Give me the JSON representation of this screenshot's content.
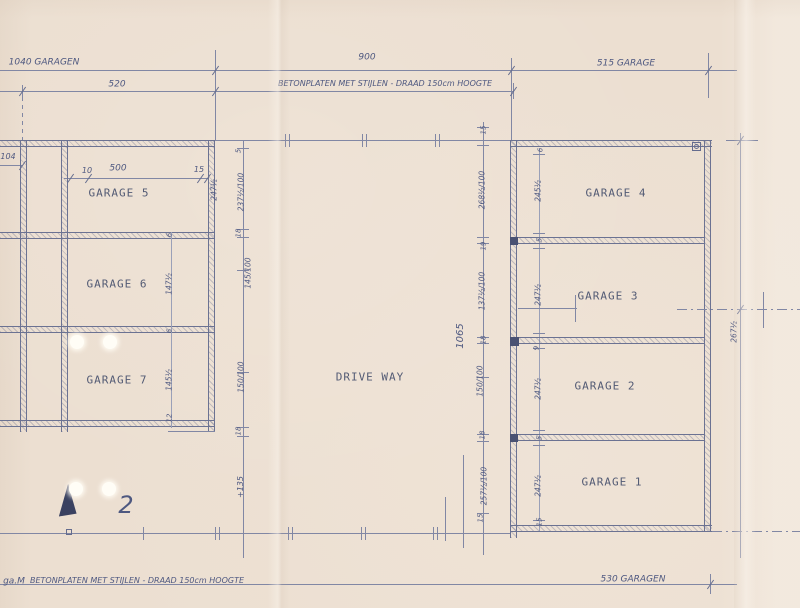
{
  "summary": {
    "sheet_kind": "garage site plan (scanned pencil drawing)",
    "sheet_number": "2",
    "rooms": [
      "GARAGE 1",
      "GARAGE 2",
      "GARAGE 3",
      "GARAGE 4",
      "GARAGE 5",
      "GARAGE 6",
      "GARAGE 7",
      "DRIVE WAY"
    ],
    "top_annotations": [
      "1040 GARAGEN",
      "520",
      "900",
      "BETONPLATEN MET STIJLEN - DRAAD 150cm HOOGTE",
      "515 GARAGE"
    ],
    "bottom_annotations": [
      "ga.M",
      "BETONPLATEN MET STIJLEN - DRAAD 150cm HOOGTE",
      "530 GARAGEN"
    ],
    "driveway_length_dim": "1065"
  },
  "paper": {
    "bg": "#ecdfd1",
    "ink": "#8187a4",
    "wall_ink": "#6b7292",
    "print_ink": "#525a74",
    "hand_ink": "#4e5880"
  },
  "drawing": {
    "north_arrow": {
      "x": 58,
      "y": 484,
      "w": 21,
      "h": 32,
      "color": "#3a4160",
      "tilt": -3
    },
    "lines": [
      {
        "t": "h",
        "x": 0,
        "y": 70,
        "l": 737
      },
      {
        "t": "v",
        "x": 215,
        "y": 50,
        "l": 90
      },
      {
        "t": "v",
        "x": 511,
        "y": 58,
        "l": 82
      },
      {
        "t": "v",
        "x": 708,
        "y": 53,
        "l": 45
      },
      {
        "t": "h",
        "x": 0,
        "y": 91,
        "l": 513
      },
      {
        "t": "v",
        "x": 22,
        "y": 85,
        "l": 12
      },
      {
        "t": "dashv",
        "x": 22,
        "y": 97,
        "l": 43
      },
      {
        "t": "v",
        "x": 513,
        "y": 83,
        "l": 16
      },
      {
        "t": "h",
        "x": 0,
        "y": 165,
        "l": 22
      },
      {
        "t": "h",
        "x": 64,
        "y": 178,
        "l": 144
      },
      {
        "t": "wallh",
        "x": 0,
        "y": 140,
        "l": 215
      },
      {
        "t": "wallv",
        "x": 20,
        "y": 140,
        "l": 292
      },
      {
        "t": "wallv",
        "x": 61,
        "y": 140,
        "l": 292
      },
      {
        "t": "wallv",
        "x": 208,
        "y": 140,
        "l": 292
      },
      {
        "t": "wallh",
        "x": 0,
        "y": 232,
        "l": 215
      },
      {
        "t": "wallh",
        "x": 0,
        "y": 326,
        "l": 215
      },
      {
        "t": "wallh",
        "x": 0,
        "y": 420,
        "l": 215
      },
      {
        "t": "h",
        "x": 168,
        "y": 431,
        "l": 47
      },
      {
        "t": "v",
        "x": 171,
        "y": 232,
        "l": 196,
        "c": "#9aa0b8"
      },
      {
        "t": "v",
        "x": 243,
        "y": 140,
        "l": 418
      },
      {
        "t": "v",
        "x": 483,
        "y": 122,
        "l": 433
      },
      {
        "t": "v",
        "x": 463,
        "y": 455,
        "l": 93
      },
      {
        "t": "v",
        "x": 445,
        "y": 497,
        "l": 44
      },
      {
        "t": "h",
        "x": 237,
        "y": 148,
        "l": 12
      },
      {
        "t": "h",
        "x": 237,
        "y": 229,
        "l": 12
      },
      {
        "t": "h",
        "x": 237,
        "y": 237,
        "l": 12
      },
      {
        "t": "h",
        "x": 237,
        "y": 270,
        "l": 12
      },
      {
        "t": "h",
        "x": 237,
        "y": 372,
        "l": 12
      },
      {
        "t": "h",
        "x": 237,
        "y": 427,
        "l": 12
      },
      {
        "t": "h",
        "x": 237,
        "y": 436,
        "l": 12
      },
      {
        "t": "h",
        "x": 477,
        "y": 127,
        "l": 12
      },
      {
        "t": "h",
        "x": 477,
        "y": 145,
        "l": 12
      },
      {
        "t": "h",
        "x": 477,
        "y": 237,
        "l": 12
      },
      {
        "t": "h",
        "x": 477,
        "y": 243,
        "l": 12
      },
      {
        "t": "h",
        "x": 477,
        "y": 337,
        "l": 12
      },
      {
        "t": "h",
        "x": 477,
        "y": 343,
        "l": 12
      },
      {
        "t": "h",
        "x": 477,
        "y": 377,
        "l": 12
      },
      {
        "t": "h",
        "x": 477,
        "y": 434,
        "l": 12
      },
      {
        "t": "h",
        "x": 477,
        "y": 441,
        "l": 12
      },
      {
        "t": "h",
        "x": 477,
        "y": 513,
        "l": 12
      },
      {
        "t": "v",
        "x": 539,
        "y": 148,
        "l": 384,
        "c": "#9aa0b8"
      },
      {
        "t": "h",
        "x": 533,
        "y": 154,
        "l": 12
      },
      {
        "t": "h",
        "x": 533,
        "y": 233,
        "l": 12
      },
      {
        "t": "h",
        "x": 533,
        "y": 248,
        "l": 12
      },
      {
        "t": "h",
        "x": 533,
        "y": 333,
        "l": 12
      },
      {
        "t": "h",
        "x": 533,
        "y": 348,
        "l": 12
      },
      {
        "t": "h",
        "x": 533,
        "y": 430,
        "l": 12
      },
      {
        "t": "h",
        "x": 533,
        "y": 445,
        "l": 12
      },
      {
        "t": "h",
        "x": 533,
        "y": 520,
        "l": 12
      },
      {
        "t": "h",
        "x": 215,
        "y": 140,
        "l": 295
      },
      {
        "t": "v",
        "x": 285,
        "y": 134,
        "l": 13
      },
      {
        "t": "v",
        "x": 289,
        "y": 134,
        "l": 13
      },
      {
        "t": "v",
        "x": 362,
        "y": 134,
        "l": 13
      },
      {
        "t": "v",
        "x": 366,
        "y": 134,
        "l": 13
      },
      {
        "t": "v",
        "x": 435,
        "y": 134,
        "l": 13
      },
      {
        "t": "v",
        "x": 439,
        "y": 134,
        "l": 13
      },
      {
        "t": "wallh",
        "x": 510,
        "y": 140,
        "l": 202
      },
      {
        "t": "wallv",
        "x": 510,
        "y": 140,
        "l": 398
      },
      {
        "t": "wallv",
        "x": 704,
        "y": 140,
        "l": 392
      },
      {
        "t": "wallh",
        "x": 518,
        "y": 237,
        "l": 186
      },
      {
        "t": "wallh",
        "x": 518,
        "y": 337,
        "l": 186
      },
      {
        "t": "wallh",
        "x": 518,
        "y": 434,
        "l": 186
      },
      {
        "t": "wallh",
        "x": 510,
        "y": 525,
        "l": 202
      },
      {
        "t": "ddh",
        "x": 712,
        "y": 531,
        "l": 88
      },
      {
        "t": "h",
        "x": 518,
        "y": 308,
        "l": 59
      },
      {
        "t": "v",
        "x": 575,
        "y": 295,
        "l": 27
      },
      {
        "t": "ddh",
        "x": 677,
        "y": 309,
        "l": 123
      },
      {
        "t": "v",
        "x": 763,
        "y": 292,
        "l": 36
      },
      {
        "t": "v",
        "x": 740,
        "y": 133,
        "l": 425
      },
      {
        "t": "h",
        "x": 726,
        "y": 140,
        "l": 32
      },
      {
        "t": "h",
        "x": 0,
        "y": 533,
        "l": 510
      },
      {
        "t": "v",
        "x": 143,
        "y": 527,
        "l": 13
      },
      {
        "t": "v",
        "x": 215,
        "y": 527,
        "l": 13
      },
      {
        "t": "v",
        "x": 219,
        "y": 527,
        "l": 13
      },
      {
        "t": "v",
        "x": 288,
        "y": 527,
        "l": 13
      },
      {
        "t": "v",
        "x": 292,
        "y": 527,
        "l": 13
      },
      {
        "t": "v",
        "x": 361,
        "y": 527,
        "l": 13
      },
      {
        "t": "v",
        "x": 365,
        "y": 527,
        "l": 13
      },
      {
        "t": "v",
        "x": 433,
        "y": 527,
        "l": 13
      },
      {
        "t": "v",
        "x": 437,
        "y": 527,
        "l": 13
      },
      {
        "t": "h",
        "x": 0,
        "y": 584,
        "l": 737
      },
      {
        "t": "v",
        "x": 710,
        "y": 574,
        "l": 20
      }
    ],
    "slashes": [
      {
        "x": 22,
        "y": 165
      },
      {
        "x": 70,
        "y": 178
      },
      {
        "x": 88,
        "y": 178
      },
      {
        "x": 200,
        "y": 178
      },
      {
        "x": 207,
        "y": 178
      },
      {
        "x": 22,
        "y": 91
      },
      {
        "x": 215,
        "y": 91
      },
      {
        "x": 513,
        "y": 91
      },
      {
        "x": 215,
        "y": 70
      },
      {
        "x": 511,
        "y": 70
      },
      {
        "x": 708,
        "y": 70
      },
      {
        "x": 710,
        "y": 584
      },
      {
        "x": 740,
        "y": 309
      },
      {
        "x": 740,
        "y": 140
      }
    ],
    "squares": [
      {
        "x": 66,
        "y": 529,
        "s": 6,
        "filled": false
      },
      {
        "x": 692,
        "y": 142,
        "s": 9,
        "filled": false
      },
      {
        "x": 510,
        "y": 237,
        "s": 8,
        "filled": true
      },
      {
        "x": 510,
        "y": 337,
        "s": 9,
        "filled": true
      },
      {
        "x": 510,
        "y": 434,
        "s": 8,
        "filled": true
      }
    ],
    "circles": [
      {
        "x": 694,
        "y": 144,
        "d": 5
      }
    ],
    "holes": [
      {
        "x": 77,
        "y": 342,
        "r": 7
      },
      {
        "x": 110,
        "y": 342,
        "r": 7
      },
      {
        "x": 76,
        "y": 489,
        "r": 7
      },
      {
        "x": 109,
        "y": 489,
        "r": 7
      }
    ],
    "labels": [
      {
        "text": "GARAGE 5",
        "x": 119,
        "y": 193,
        "s": 11,
        "f": "print",
        "ls": 1,
        "name": "room-label-garage-5"
      },
      {
        "text": "GARAGE 6",
        "x": 117,
        "y": 284,
        "s": 11,
        "f": "print",
        "ls": 1,
        "name": "room-label-garage-6"
      },
      {
        "text": "GARAGE 7",
        "x": 117,
        "y": 380,
        "s": 11,
        "f": "print",
        "ls": 1,
        "name": "room-label-garage-7"
      },
      {
        "text": "GARAGE 4",
        "x": 616,
        "y": 193,
        "s": 11,
        "f": "print",
        "ls": 1,
        "name": "room-label-garage-4"
      },
      {
        "text": "GARAGE 3",
        "x": 608,
        "y": 296,
        "s": 11,
        "f": "print",
        "ls": 1,
        "name": "room-label-garage-3"
      },
      {
        "text": "GARAGE 2",
        "x": 605,
        "y": 386,
        "s": 11,
        "f": "print",
        "ls": 1,
        "name": "room-label-garage-2"
      },
      {
        "text": "GARAGE 1",
        "x": 612,
        "y": 482,
        "s": 11,
        "f": "print",
        "ls": 1,
        "name": "room-label-garage-1"
      },
      {
        "text": "DRIVE WAY",
        "x": 370,
        "y": 377,
        "s": 11,
        "f": "print",
        "ls": 1,
        "name": "driveway-label"
      },
      {
        "text": "1040 GARAGEN",
        "x": 44,
        "y": 63,
        "s": 9,
        "f": "hand",
        "name": "dim-total-left"
      },
      {
        "text": "520",
        "x": 117,
        "y": 85,
        "s": 9,
        "f": "hand",
        "name": "dim-left-bay"
      },
      {
        "text": "900",
        "x": 367,
        "y": 58,
        "s": 9,
        "f": "hand",
        "name": "dim-top-middle"
      },
      {
        "text": "BETONPLATEN MET STIJLEN - DRAAD 150cm HOOGTE",
        "x": 385,
        "y": 84,
        "s": 8,
        "f": "hand",
        "name": "fence-note-top"
      },
      {
        "text": "515 GARAGE",
        "x": 626,
        "y": 64,
        "s": 9,
        "f": "hand",
        "name": "dim-top-right"
      },
      {
        "text": "104",
        "x": 8,
        "y": 157,
        "s": 8,
        "f": "hand",
        "name": "dim-left-cut"
      },
      {
        "text": "10",
        "x": 87,
        "y": 171,
        "s": 8,
        "f": "hand",
        "name": "dim-g5-offset"
      },
      {
        "text": "500",
        "x": 118,
        "y": 169,
        "s": 9,
        "f": "hand",
        "name": "dim-g5-width"
      },
      {
        "text": "15",
        "x": 199,
        "y": 170,
        "s": 8,
        "f": "hand",
        "name": "dim-g5-wall"
      },
      {
        "text": "ga.M",
        "x": 14,
        "y": 582,
        "s": 9,
        "f": "hand",
        "name": "note-bottom-left"
      },
      {
        "text": "BETONPLATEN MET STIJLEN - DRAAD 150cm HOOGTE",
        "x": 137,
        "y": 581,
        "s": 8,
        "f": "hand",
        "name": "fence-note-bottom"
      },
      {
        "text": "530 GARAGEN",
        "x": 633,
        "y": 580,
        "s": 9,
        "f": "hand",
        "name": "dim-bottom-right"
      },
      {
        "text": "2",
        "x": 126,
        "y": 505,
        "s": 24,
        "f": "hand",
        "name": "sheet-number"
      },
      {
        "text": "247½",
        "x": 214,
        "y": 190,
        "s": 7.5,
        "f": "hand",
        "r": -90,
        "name": "dim-label"
      },
      {
        "text": "6",
        "x": 170,
        "y": 235,
        "s": 7,
        "f": "hand",
        "r": -90,
        "name": "dim-label"
      },
      {
        "text": "147½",
        "x": 169,
        "y": 284,
        "s": 7.5,
        "f": "hand",
        "r": -90,
        "name": "dim-label"
      },
      {
        "text": "6",
        "x": 170,
        "y": 331,
        "s": 7,
        "f": "hand",
        "r": -90,
        "name": "dim-label"
      },
      {
        "text": "145½",
        "x": 169,
        "y": 380,
        "s": 7.5,
        "f": "hand",
        "r": -90,
        "name": "dim-label"
      },
      {
        "text": "12",
        "x": 170,
        "y": 418,
        "s": 7,
        "f": "hand",
        "r": -90,
        "name": "dim-label"
      },
      {
        "text": "5",
        "x": 239,
        "y": 151,
        "s": 7,
        "f": "hand",
        "r": -90,
        "name": "dim-label"
      },
      {
        "text": "237½/100",
        "x": 241,
        "y": 192,
        "s": 7.5,
        "f": "hand",
        "r": -90,
        "name": "dim-label"
      },
      {
        "text": "18",
        "x": 239,
        "y": 233,
        "s": 7,
        "f": "hand",
        "r": -90,
        "name": "dim-label"
      },
      {
        "text": "145/100",
        "x": 248,
        "y": 273,
        "s": 7.5,
        "f": "hand",
        "r": -90,
        "name": "dim-label"
      },
      {
        "text": "150/100",
        "x": 241,
        "y": 377,
        "s": 7.5,
        "f": "hand",
        "r": -90,
        "name": "dim-label"
      },
      {
        "text": "18",
        "x": 239,
        "y": 431,
        "s": 7,
        "f": "hand",
        "r": -90,
        "name": "dim-label"
      },
      {
        "text": "+135",
        "x": 241,
        "y": 487,
        "s": 8,
        "f": "hand",
        "r": -90,
        "name": "dim-label"
      },
      {
        "text": "15",
        "x": 484,
        "y": 130,
        "s": 7,
        "f": "hand",
        "r": -90,
        "name": "dim-label"
      },
      {
        "text": "268½/100",
        "x": 482,
        "y": 190,
        "s": 7.5,
        "f": "hand",
        "r": -90,
        "name": "dim-label"
      },
      {
        "text": "19",
        "x": 484,
        "y": 246,
        "s": 7,
        "f": "hand",
        "r": -90,
        "name": "dim-label"
      },
      {
        "text": "137½/100",
        "x": 482,
        "y": 291,
        "s": 7.5,
        "f": "hand",
        "r": -90,
        "name": "dim-label"
      },
      {
        "text": "18",
        "x": 484,
        "y": 340,
        "s": 7,
        "f": "hand",
        "r": -90,
        "name": "dim-label"
      },
      {
        "text": "150/100",
        "x": 480,
        "y": 381,
        "s": 7.5,
        "f": "hand",
        "r": -90,
        "name": "dim-label"
      },
      {
        "text": "18",
        "x": 483,
        "y": 435,
        "s": 7,
        "f": "hand",
        "r": -90,
        "name": "dim-label"
      },
      {
        "text": "257½/100",
        "x": 484,
        "y": 486,
        "s": 7.5,
        "f": "hand",
        "r": -90,
        "name": "dim-label"
      },
      {
        "text": "15",
        "x": 481,
        "y": 518,
        "s": 7,
        "f": "hand",
        "r": -90,
        "name": "dim-label"
      },
      {
        "text": "1065",
        "x": 461,
        "y": 336,
        "s": 10,
        "f": "hand",
        "r": -90,
        "name": "dim-driveway-length"
      },
      {
        "text": "6",
        "x": 541,
        "y": 150,
        "s": 7,
        "f": "hand",
        "r": -90,
        "name": "dim-label"
      },
      {
        "text": "245½",
        "x": 538,
        "y": 191,
        "s": 7.5,
        "f": "hand",
        "r": -90,
        "name": "dim-label"
      },
      {
        "text": "5",
        "x": 540,
        "y": 240,
        "s": 7,
        "f": "hand",
        "r": -90,
        "name": "dim-label"
      },
      {
        "text": "247½",
        "x": 538,
        "y": 295,
        "s": 7.5,
        "f": "hand",
        "r": -90,
        "name": "dim-label"
      },
      {
        "text": "9",
        "x": 537,
        "y": 348,
        "s": 7,
        "f": "hand",
        "r": -90,
        "name": "dim-label"
      },
      {
        "text": "247½",
        "x": 538,
        "y": 389,
        "s": 7.5,
        "f": "hand",
        "r": -90,
        "name": "dim-label"
      },
      {
        "text": "5",
        "x": 540,
        "y": 438,
        "s": 7,
        "f": "hand",
        "r": -90,
        "name": "dim-label"
      },
      {
        "text": "247½",
        "x": 538,
        "y": 486,
        "s": 7.5,
        "f": "hand",
        "r": -90,
        "name": "dim-label"
      },
      {
        "text": "15",
        "x": 540,
        "y": 522,
        "s": 7,
        "f": "hand",
        "r": -90,
        "name": "dim-label"
      },
      {
        "text": "267½",
        "x": 734,
        "y": 332,
        "s": 7.5,
        "f": "hand",
        "r": -90,
        "name": "dim-right-edge"
      }
    ]
  }
}
